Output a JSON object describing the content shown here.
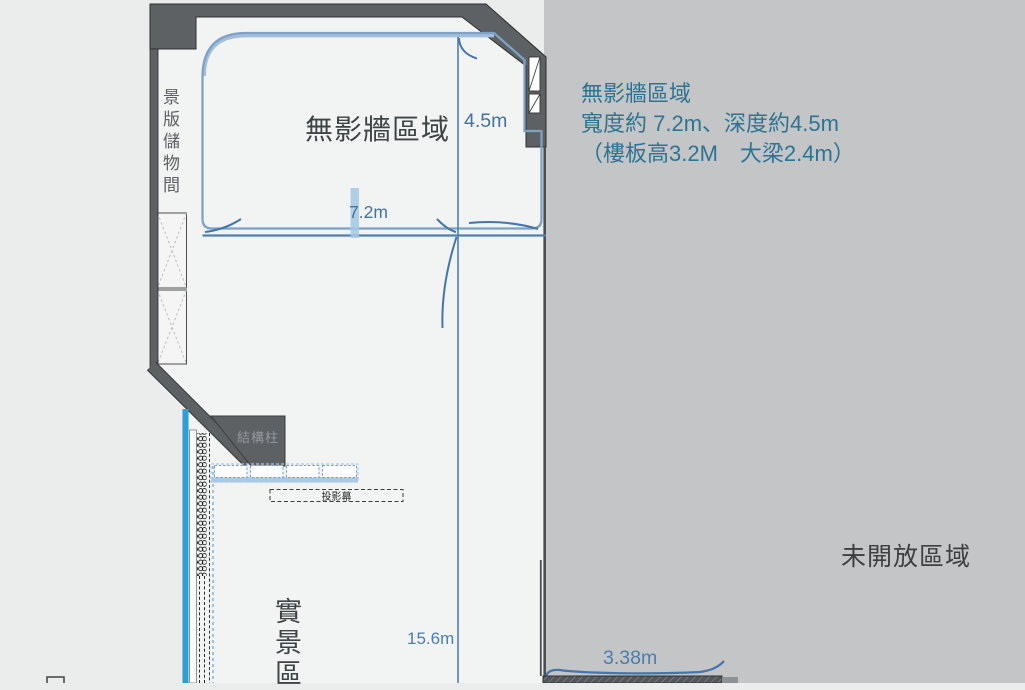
{
  "plan": {
    "storage_room_label": "景版儲物間",
    "shadowless_area_label": "無影牆區域",
    "structural_column_label": "結構柱",
    "projection_screen_label": "投影幕",
    "reality_area_label": "實景區",
    "dim_depth": "4.5m",
    "dim_width": "7.2m",
    "dim_total_depth": "15.6m",
    "dim_opening_width": "3.38m"
  },
  "info_panel": {
    "title": "無影牆區域",
    "size_line": "寬度約 7.2m、深度約4.5m",
    "height_line": "（樓板高3.2M　大梁2.4m）",
    "restricted_area_label": "未開放區域"
  },
  "colors": {
    "accent_blue": "#4f80b2",
    "outline_blue": "#7da2c6",
    "bright_blue_track": "#2b9fd6",
    "teal_text": "#2d7493",
    "dimension_text": "#4b7dad",
    "wall_gray": "#5e6164",
    "panel_gray": "#c4c5c6",
    "floor_white": "#f2f3f3"
  }
}
